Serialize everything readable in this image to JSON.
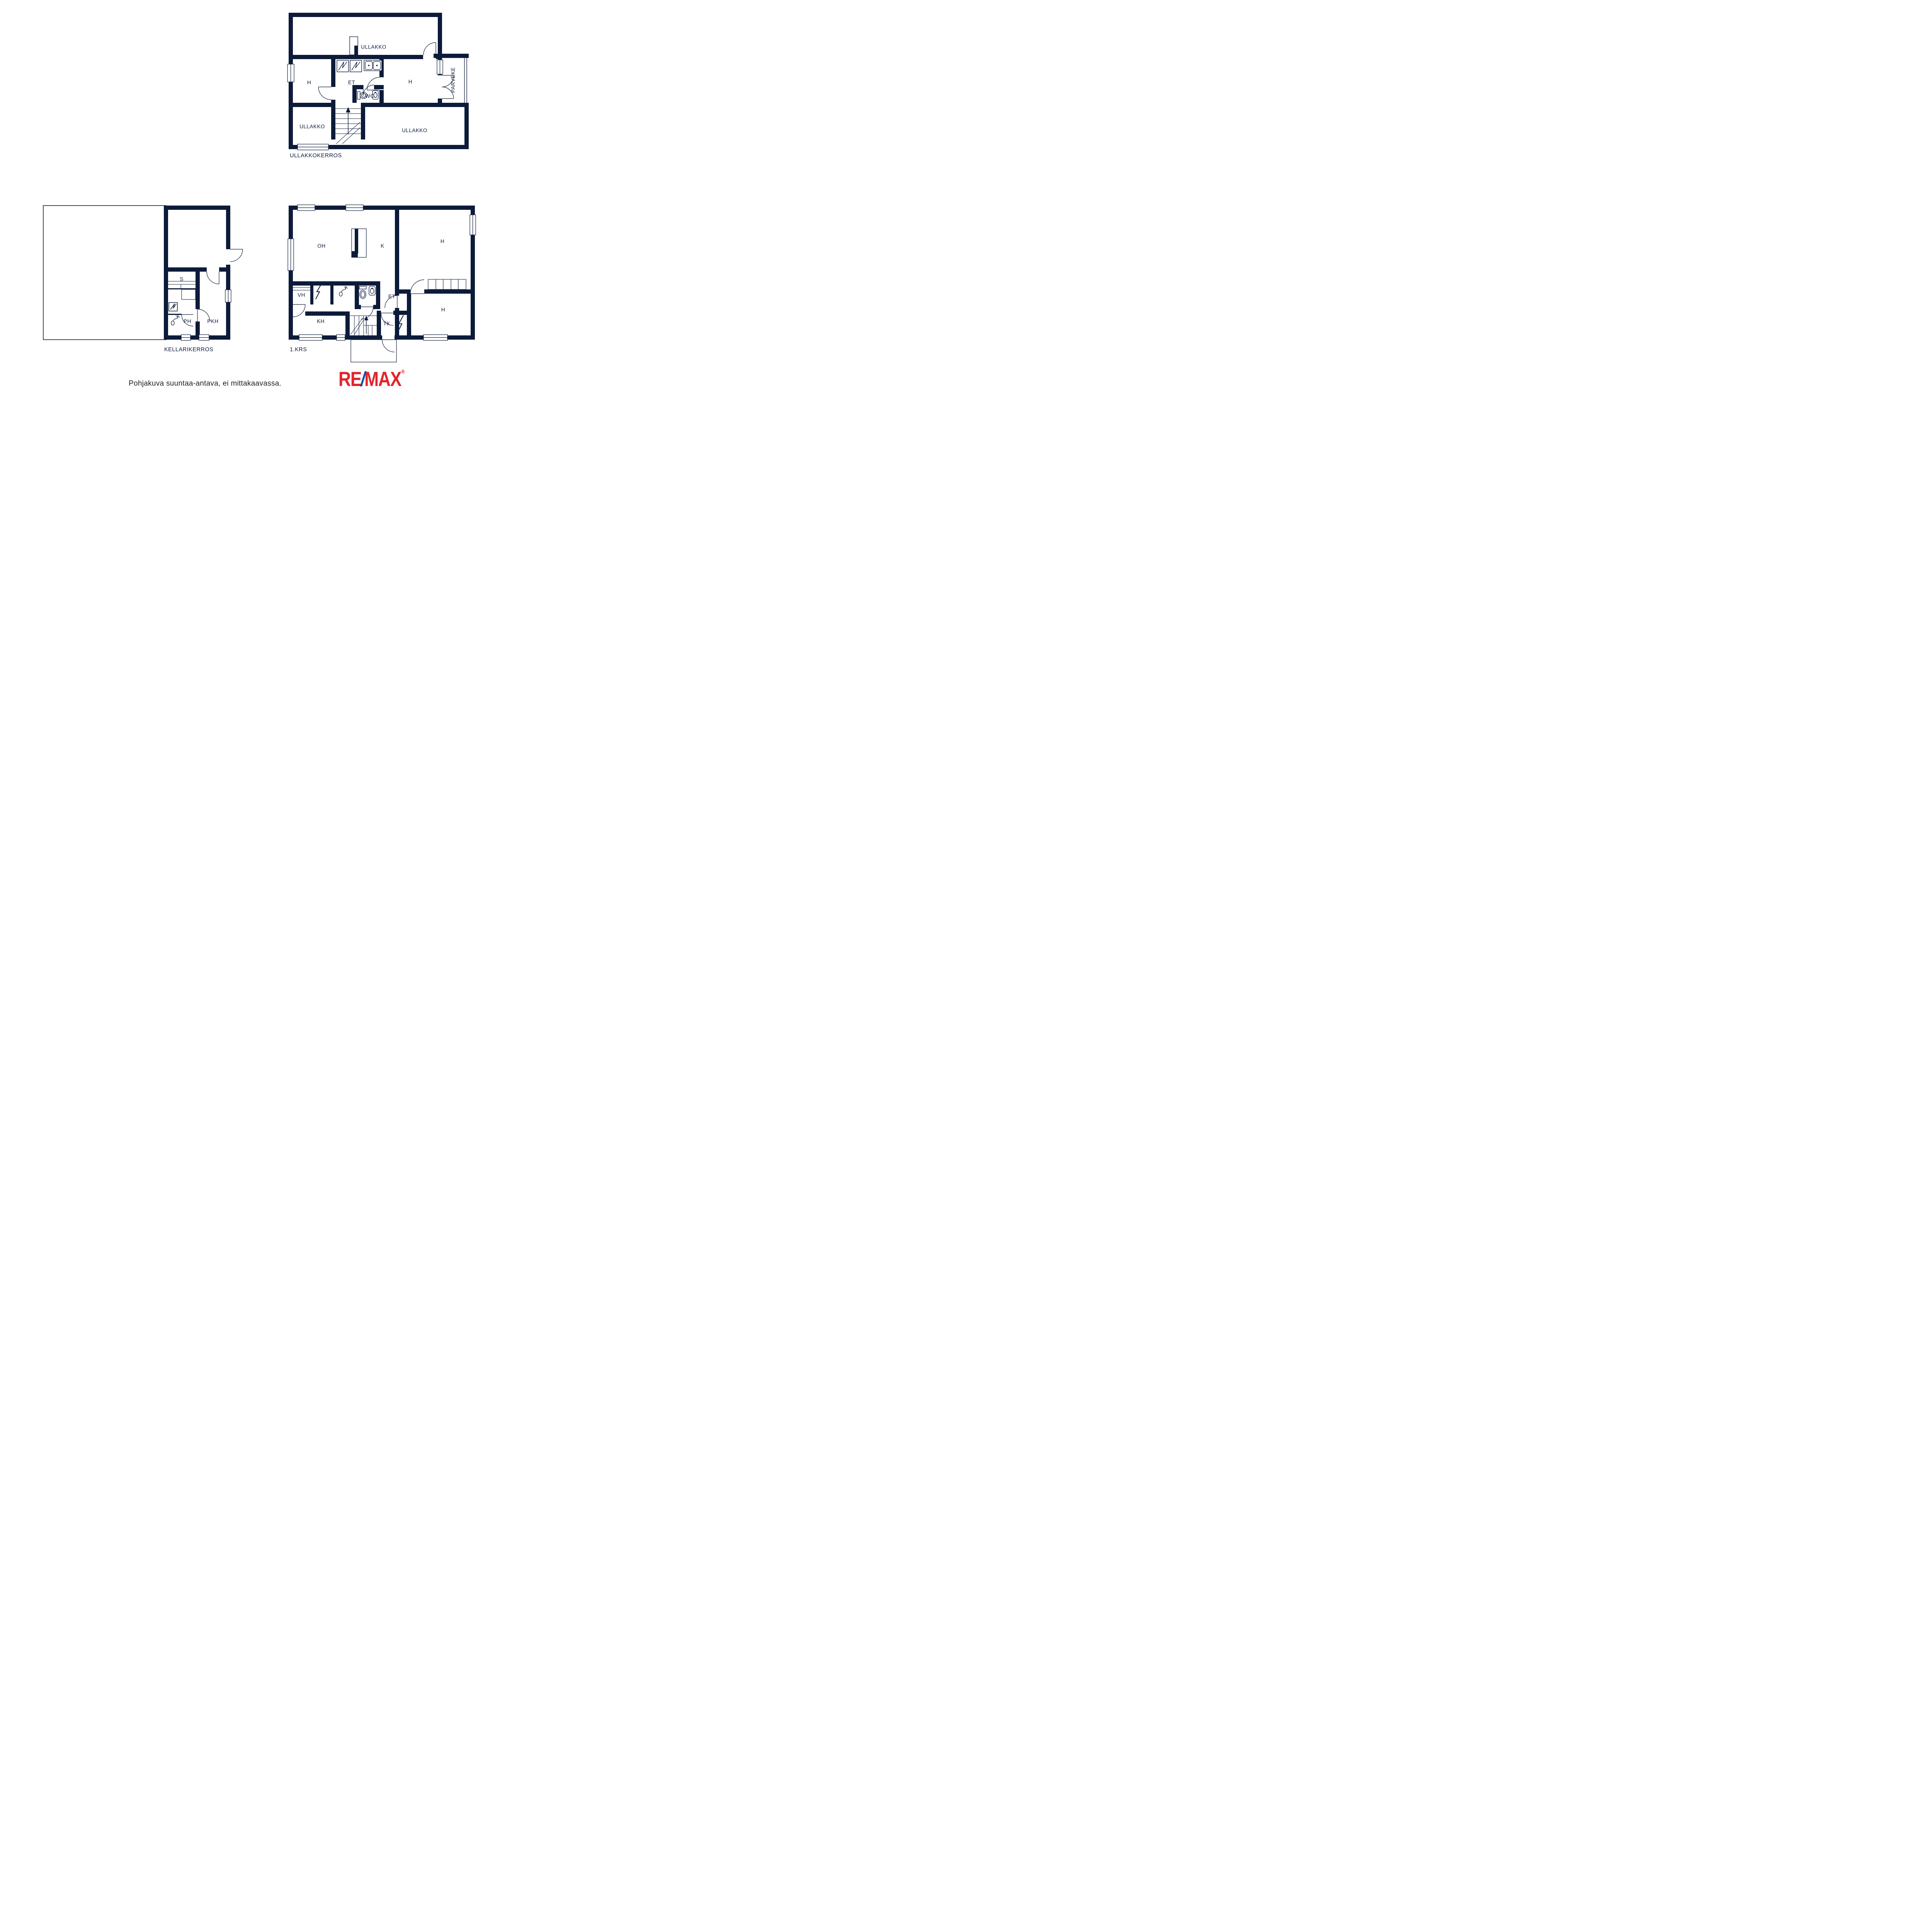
{
  "colors": {
    "wall_navy": "#0d1b3a",
    "disclaimer_text": "#1d1d1b",
    "remax_red": "#e1252b",
    "remax_blue": "#1550a5"
  },
  "plans": {
    "attic": {
      "title": "ULLAKKOKERROS",
      "rooms": {
        "ullakko_top": "ULLAKKO",
        "h_left": "H",
        "et": "ET",
        "wc": "WC",
        "h_right": "H",
        "parveke": "PARVEKE",
        "ullakko_bottom_left": "ULLAKKO",
        "ullakko_bottom_right": "ULLAKKO"
      }
    },
    "first_floor": {
      "title": "1.KRS",
      "rooms": {
        "oh": "OH",
        "k": "K",
        "h_top_right": "H",
        "vh": "VH",
        "et": "ET",
        "kh": "KH",
        "tk": "TK",
        "h_bottom_right": "H"
      }
    },
    "basement": {
      "title": "KELLARIKERROS",
      "rooms": {
        "s": "S",
        "ph": "PH",
        "pkh": "PKH"
      }
    }
  },
  "footer": {
    "disclaimer": "Pohjakuva suuntaa-antava, ei mittakaavassa.",
    "logo": {
      "re": "RE",
      "slash": "/",
      "max": "MAX",
      "registered": "®"
    }
  }
}
